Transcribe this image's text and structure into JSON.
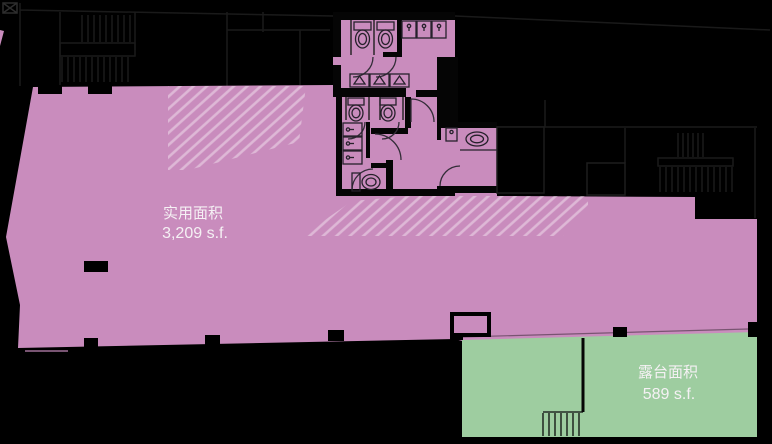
{
  "floorplan": {
    "areas": {
      "usable": {
        "label": "实用面积",
        "value": "3,209 s.f."
      },
      "terrace": {
        "label": "露台面积",
        "value": "589 s.f."
      }
    },
    "colors": {
      "background": "#000000",
      "usable_fill": "#c98cbd",
      "terrace_fill": "#9ecda0",
      "hatch_stroke": "rgba(255,255,255,0.38)",
      "label_text": "#f5f1f4"
    }
  }
}
